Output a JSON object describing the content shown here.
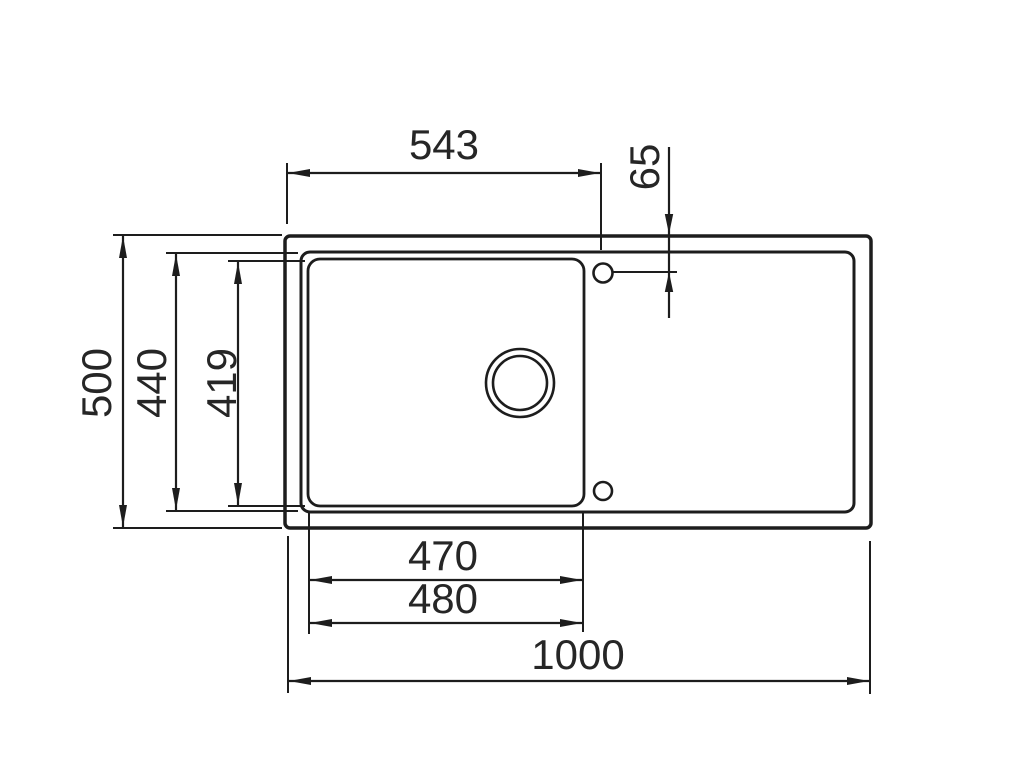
{
  "drawing": {
    "type": "technical-dimension-drawing",
    "subject": "kitchen sink with single bowl and drainer board, top view",
    "units": "mm",
    "labels": {
      "tap_hole_offset_x": "543",
      "tap_hole_offset_y": "65",
      "overall_depth": "500",
      "rim_depth": "440",
      "bowl_depth": "419",
      "bowl_width_inner": "470",
      "bowl_width_outer": "480",
      "overall_width": "1000"
    },
    "colors": {
      "background": "#ffffff",
      "line": "#1d1d1d",
      "text": "#262626"
    }
  }
}
